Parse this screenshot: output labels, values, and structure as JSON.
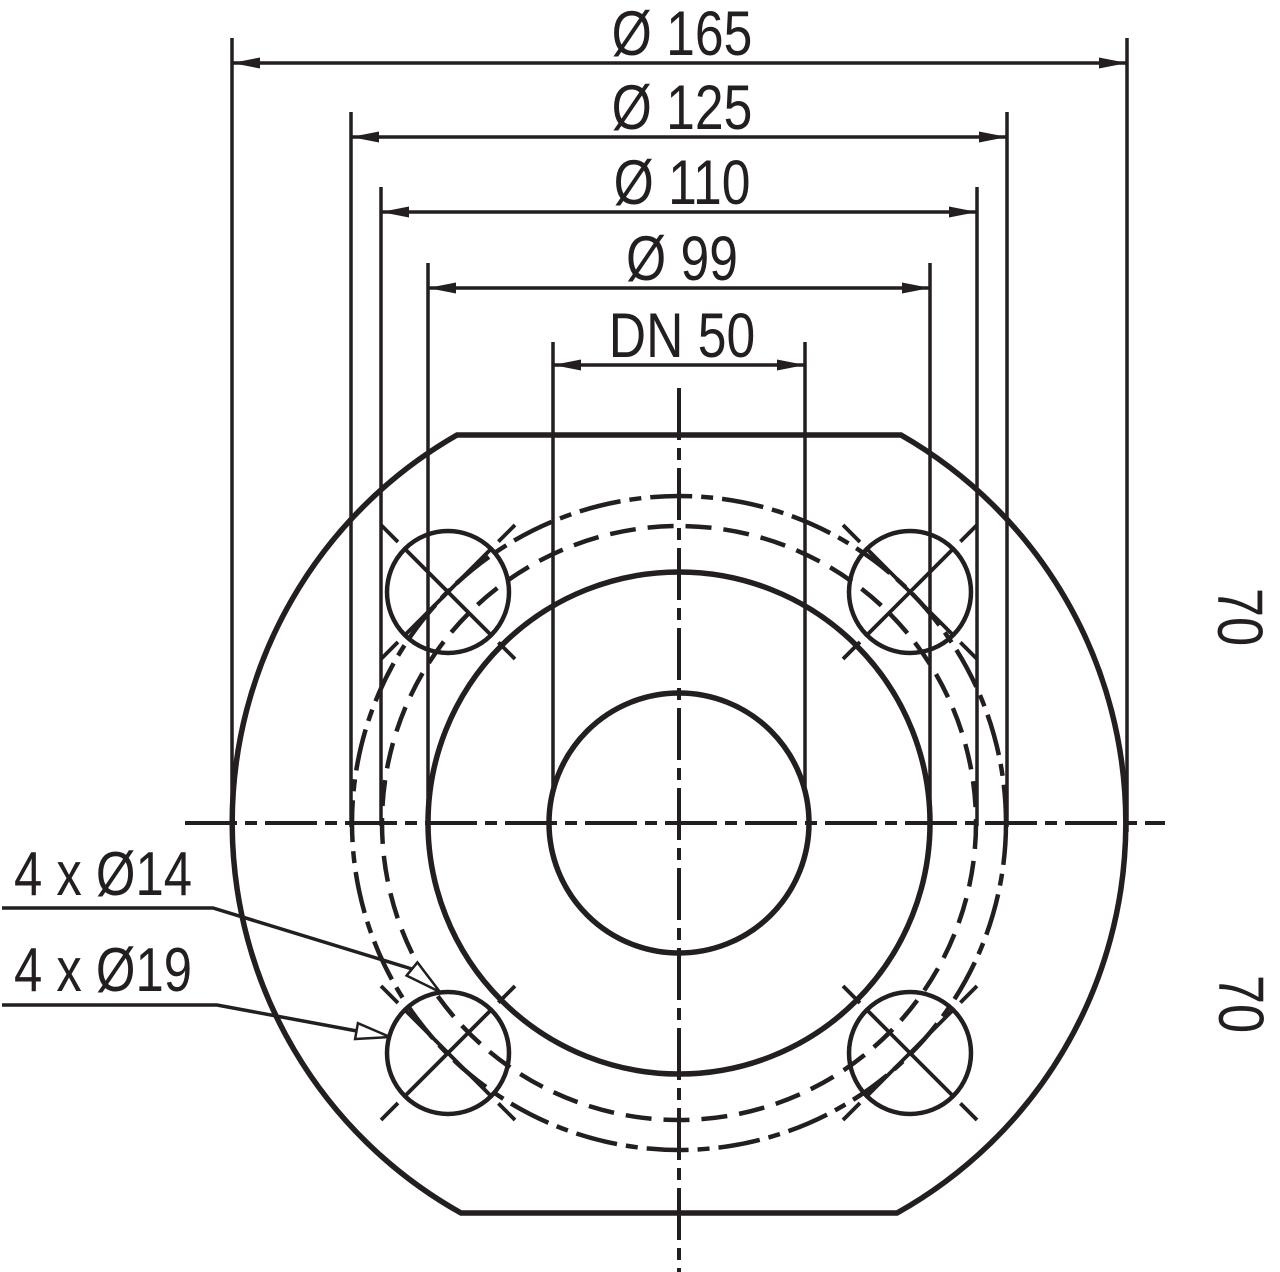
{
  "drawing": {
    "background": "#ffffff",
    "line_color": "#231f20",
    "diameter_dimensions": [
      {
        "label": "Ø 165"
      },
      {
        "label": "Ø 125"
      },
      {
        "label": "Ø 110"
      },
      {
        "label": "Ø 99"
      },
      {
        "label": "DN 50"
      }
    ],
    "vertical_dimensions": [
      {
        "label": "70"
      },
      {
        "label": "70"
      }
    ],
    "hole_callouts": [
      {
        "label": "4 x Ø14"
      },
      {
        "label": "4 x Ø19"
      }
    ]
  }
}
